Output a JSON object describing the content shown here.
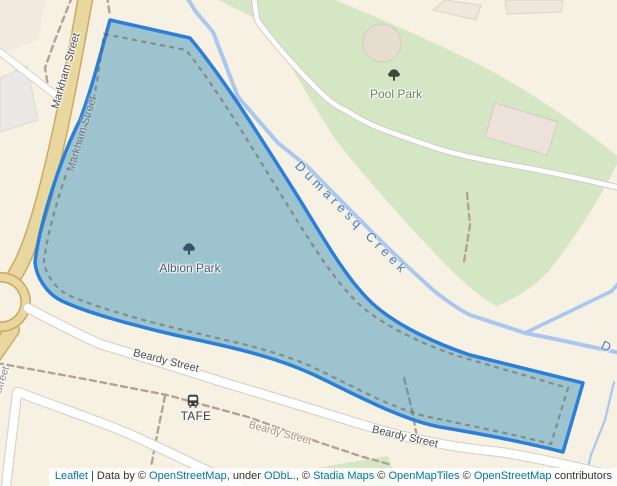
{
  "labels": {
    "pool_park": "Pool Park",
    "albion_park": "Albion Park",
    "dumaresq_creek": "Dumaresq Creek",
    "dumaresq_creek_partial": "D",
    "markham_street_road": "Markham Street",
    "markham_street_path": "Markham Street",
    "beardy_street_1": "Beardy Street",
    "beardy_street_2": "Beardy Street",
    "beardy_street_old": "Beardy Street",
    "street_partial": "Street",
    "tafe": "TAFE"
  },
  "icons": {
    "pool_park": "tree-icon",
    "albion_park": "tree-icon",
    "tafe": "bus-icon"
  },
  "colors": {
    "background": "#f7f1e3",
    "park_green": "#d4e6c4",
    "highlight_stroke": "#2b7fd9",
    "highlight_fill": "rgba(45,140,180,0.45)",
    "creek": "#a9c7ef",
    "creek_label": "#4a7ecb",
    "road_primary_fill": "#e8d8a0",
    "road_primary_casing": "#cfa761",
    "road_white": "#ffffff",
    "link": "#0078a8"
  },
  "attribution": {
    "parts": [
      {
        "text": "Leaflet",
        "link": true
      },
      {
        "text": " | Data by © ",
        "link": false
      },
      {
        "text": "OpenStreetMap",
        "link": true
      },
      {
        "text": ", under ",
        "link": false
      },
      {
        "text": "ODbL.",
        "link": true
      },
      {
        "text": ", © ",
        "link": false
      },
      {
        "text": "Stadia Maps",
        "link": true
      },
      {
        "text": " © ",
        "link": false
      },
      {
        "text": "OpenMapTiles",
        "link": true
      },
      {
        "text": " © ",
        "link": false
      },
      {
        "text": "OpenStreetMap",
        "link": true
      },
      {
        "text": " contributors",
        "link": false
      }
    ]
  }
}
